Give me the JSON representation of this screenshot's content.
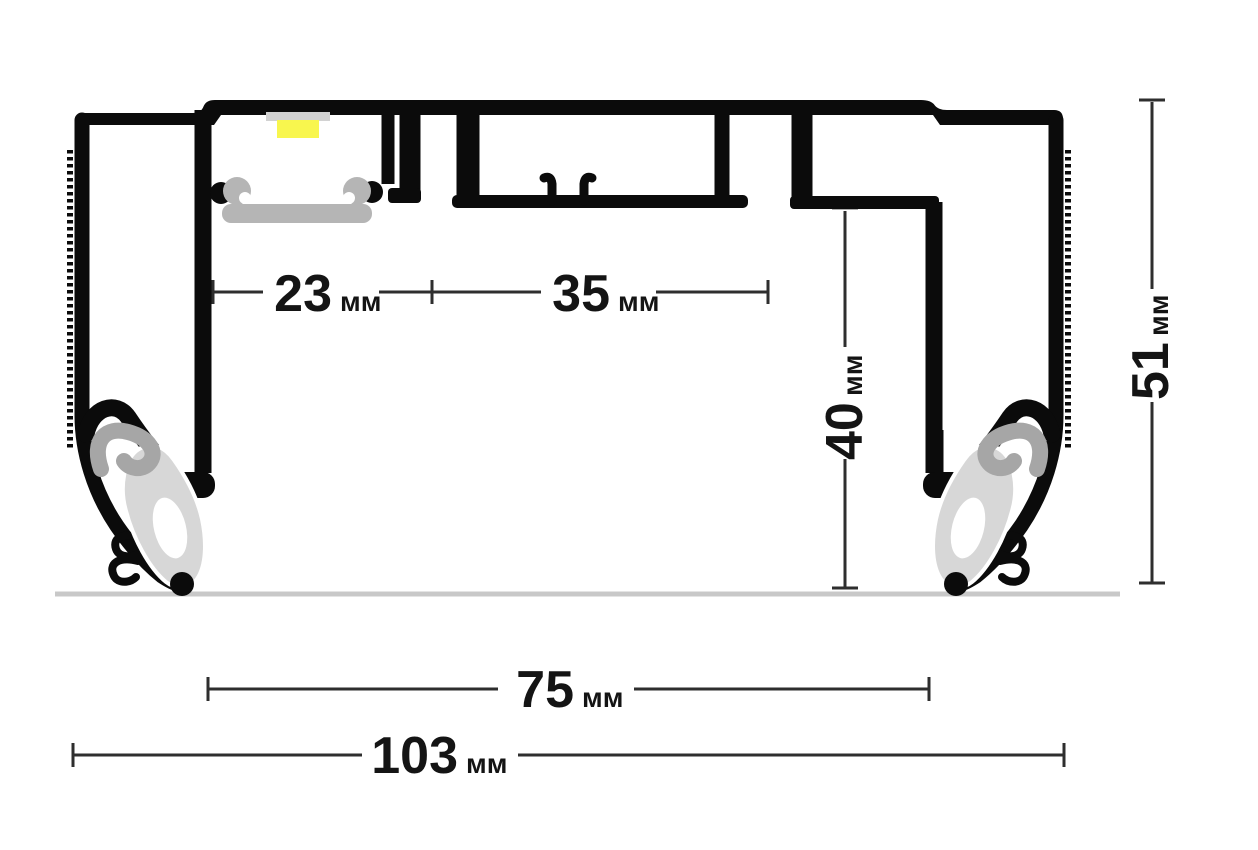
{
  "unit": "мм",
  "dimensions": [
    {
      "label": "23",
      "unit": "мм",
      "orientation": "horizontal",
      "measures": "led-channel-width"
    },
    {
      "label": "35",
      "unit": "мм",
      "orientation": "horizontal",
      "measures": "center-channel-width"
    },
    {
      "label": "40",
      "unit": "мм",
      "orientation": "vertical",
      "measures": "inner-height"
    },
    {
      "label": "51",
      "unit": "мм",
      "orientation": "vertical",
      "measures": "overall-height"
    },
    {
      "label": "75",
      "unit": "мм",
      "orientation": "horizontal",
      "measures": "inner-opening-width"
    },
    {
      "label": "103",
      "unit": "мм",
      "orientation": "horizontal",
      "measures": "overall-width"
    }
  ],
  "colors": {
    "outline": "#0b0b0b",
    "diffuser_gray": "#b5b5b5",
    "insert_gray": "#a6a6a6",
    "boot_gray": "#d7d7d7",
    "pcb_gray": "#d2d2d2",
    "led_yellow": "#f8f64e",
    "ceiling_line": "#c8c8c8",
    "dimension_line": "#2e2e2e"
  }
}
